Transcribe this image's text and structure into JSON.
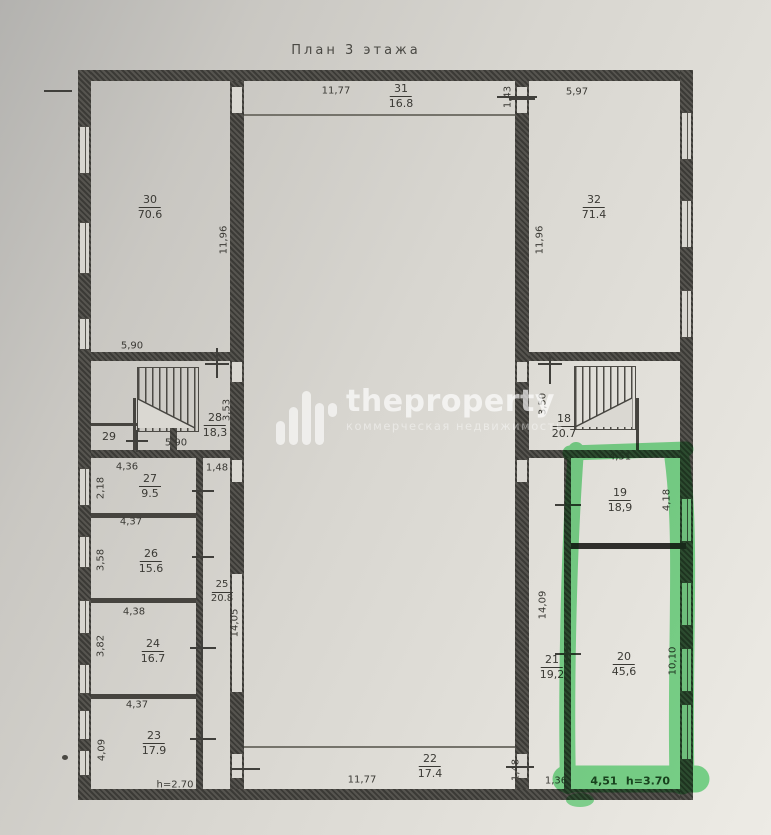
{
  "title": "План 3 этажа",
  "watermark": {
    "brand": "theproperty",
    "tagline": "коммерческая недвижимость"
  },
  "colors": {
    "highlight": "#66dd80",
    "wall": "#3b3a36",
    "paper": "#d9d7d1",
    "ink": "#3a3934"
  },
  "rooms": {
    "r30": {
      "num": "30",
      "area": "70.6"
    },
    "r31": {
      "num": "31",
      "area": "16.8"
    },
    "r32": {
      "num": "32",
      "area": "71.4"
    },
    "r28": {
      "num": "28",
      "area": "18,3"
    },
    "r29": {
      "num": "29"
    },
    "r18": {
      "num": "18",
      "area": "20.7"
    },
    "r27": {
      "num": "27",
      "area": "9.5"
    },
    "r26": {
      "num": "26",
      "area": "15.6"
    },
    "r25": {
      "num": "25",
      "area": "20.8"
    },
    "r24": {
      "num": "24",
      "area": "16.7"
    },
    "r23": {
      "num": "23",
      "area": "17.9"
    },
    "r22": {
      "num": "22",
      "area": "17.4"
    },
    "r21": {
      "num": "21",
      "area": "19,2"
    },
    "r19": {
      "num": "19",
      "area": "18,9"
    },
    "r20": {
      "num": "20",
      "area": "45,6"
    }
  },
  "dims": {
    "top_width": "11,77",
    "top_right_width": "5,97",
    "entry_height": "1,43",
    "left_hall_height": "11,96",
    "right_hall_height": "11,96",
    "stairs_left_width_top": "5,90",
    "stairs_left_width_bottom": "5,90",
    "stairs_left_depth": "3,53",
    "stairs_right_depth": "3,50",
    "room27_width": "4,36",
    "corridor_top_width": "1,48",
    "room27_depth": "2,18",
    "room26_width": "4,37",
    "room26_depth": "3,58",
    "room24_width": "4,38",
    "room24_depth": "3,82",
    "room23_width": "4,37",
    "room23_depth": "4,09",
    "corridor25_length": "14,05",
    "corridor21_length": "14,09",
    "room19_width": "4,51",
    "room19_depth": "4,18",
    "room20_depth": "10,10",
    "bottom_width": "11,77",
    "bottom_inner_height": "1,48",
    "bottom_small_width": "1,36",
    "highlight_width": "4,51",
    "highlight_height_note": "h=3.70",
    "left_height_note": "h=2.70"
  }
}
